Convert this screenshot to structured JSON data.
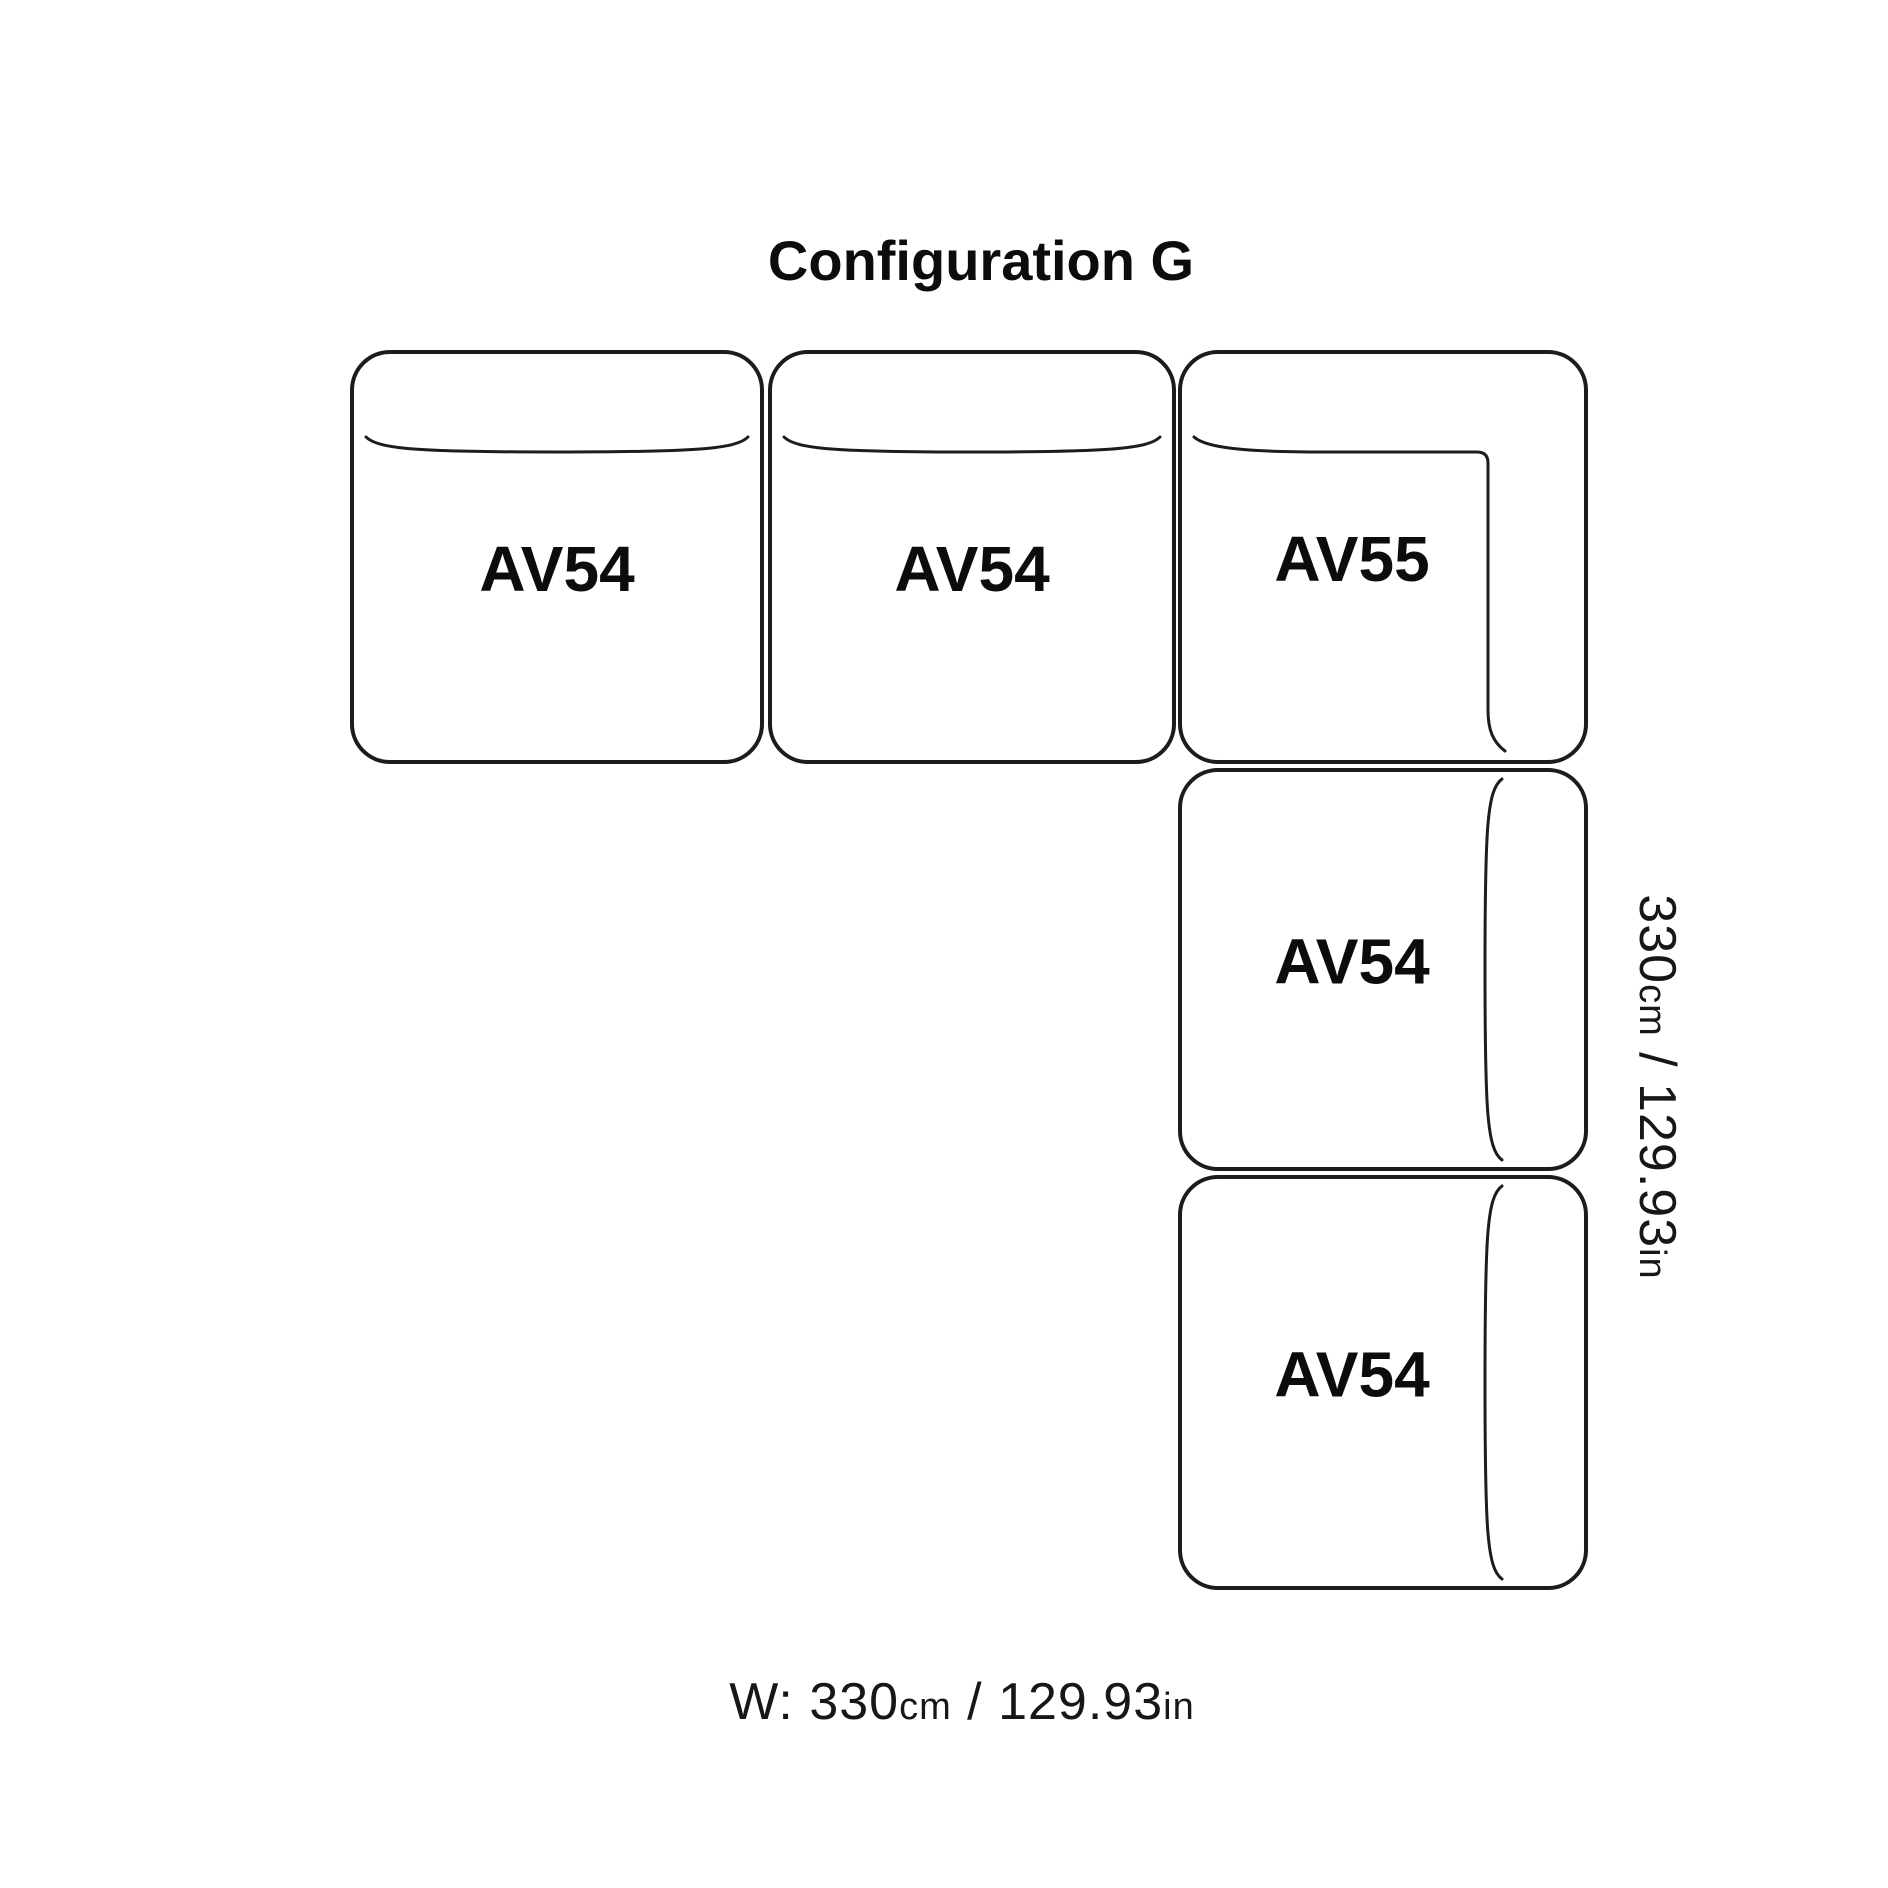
{
  "title": {
    "text": "Configuration G"
  },
  "diagram": {
    "stroke_color": "#1c1c1c",
    "text_color": "#0c0c0c",
    "background": "#ffffff",
    "modules": [
      {
        "name": "module-av54-a",
        "label": "AV54",
        "type": "horizontal",
        "x": 352,
        "y": 352,
        "w": 410,
        "h": 410
      },
      {
        "name": "module-av54-b",
        "label": "AV54",
        "type": "horizontal",
        "x": 770,
        "y": 352,
        "w": 404,
        "h": 410
      },
      {
        "name": "module-av55-corner",
        "label": "AV55",
        "type": "corner",
        "x": 1180,
        "y": 352,
        "w": 406,
        "h": 410
      },
      {
        "name": "module-av54-c",
        "label": "AV54",
        "type": "vertical",
        "x": 1180,
        "y": 770,
        "w": 406,
        "h": 399
      },
      {
        "name": "module-av54-d",
        "label": "AV54",
        "type": "vertical",
        "x": 1180,
        "y": 1177,
        "w": 406,
        "h": 411
      }
    ],
    "dimension_width": {
      "full_text": "W: 330cm / 129.93in",
      "parts": [
        {
          "text": "W: 330",
          "size": "lg"
        },
        {
          "text": "cm",
          "size": "sm"
        },
        {
          "text": " / 129.93",
          "size": "lg"
        },
        {
          "text": "in",
          "size": "sm"
        }
      ]
    },
    "dimension_height": {
      "full_text": "330cm / 129.93in",
      "parts": [
        {
          "text": "330",
          "size": "lg"
        },
        {
          "text": "cm",
          "size": "sm"
        },
        {
          "text": " / 129.93",
          "size": "lg"
        },
        {
          "text": "in",
          "size": "sm"
        }
      ]
    }
  }
}
